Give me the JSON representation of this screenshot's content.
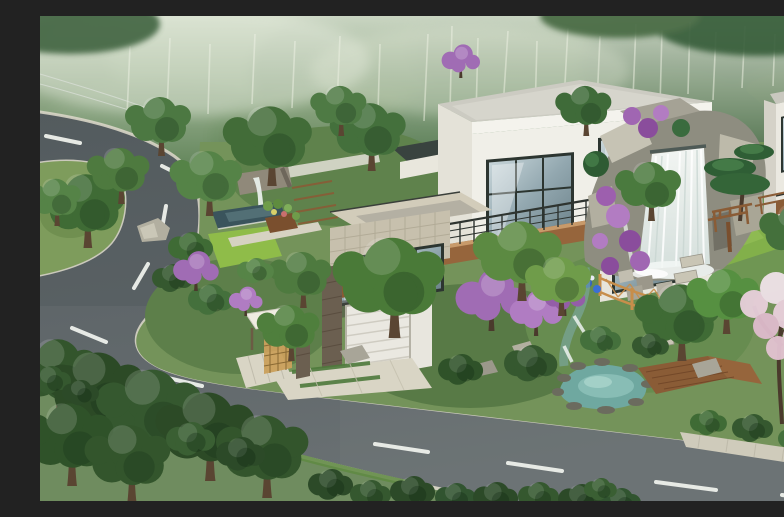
{
  "meta": {
    "title": "Hillside Villa Landscape Rendering",
    "alt": "Aerial 3D architectural rendering of a modern flat-roofed villa on a forested hillside, with a curved asphalt road with white dashed lane markings, a grass traffic island, terraced gardens, a large rock waterfall with purple bougainvillea, a turquoise garden pond with wooden deck, an entrance gate with white canopy, and misty birch forest in the background."
  },
  "scene": {
    "background_forest": {
      "label": "Misty forest backdrop with birch trunks",
      "haze": "#e3ead9",
      "far_green": "#7d9672",
      "mid_green": "#55744e"
    },
    "road": {
      "label": "Curved asphalt road (S-bend with hairpin)",
      "surface": "#5f676a",
      "lane_dash": "#eef1ec",
      "curb": "#d8d5c6",
      "sidewalk": "#cfccbc",
      "dash_count": 12
    },
    "traffic_island": {
      "label": "Grass island with trees",
      "grass": "#7e9c5c",
      "tree_count": 3
    },
    "villa": {
      "label": "Modern flat-roof villa with garage",
      "wall_white": "#f0efe8",
      "roof": "#cccbc2",
      "tile_cladding": "#c7c0ad",
      "wood_accent": "#96653c",
      "window_frame": "#2c3530",
      "glass": "#a9bcc2",
      "garage_door": "#eae8e1",
      "stone_pier": "#6b5f50"
    },
    "neighbor_house": {
      "label": "Neighboring villa at right edge",
      "wall": "#ebe9e1",
      "wood_band": "#8a5c36"
    },
    "entrance_gate": {
      "label": "Entrance gate with white canopy and lattice door",
      "canopy": "#efece1",
      "lattice": "#caa05c"
    },
    "pool_garden": {
      "label": "Reflecting-pool terrace with small waterfall and planters",
      "pool_water": "#3a545c",
      "stone_wall": "#90897a",
      "soil_bed": "#7a4f2e"
    },
    "waterfall": {
      "label": "Large rock waterfall",
      "rock_light": "#c6c3b4",
      "rock_mid": "#8e8d80",
      "water": "#edf2ef",
      "bougainvillea": "#9d5fae"
    },
    "pond": {
      "label": "Turquoise garden pond",
      "water": "#6fa8a0",
      "shallow": "#8fc2ba"
    },
    "deck": {
      "label": "Wooden deck and bridge",
      "wood": "#8a5c36"
    },
    "fence": {
      "label": "Wooden lattice fence around spa stones",
      "wood": "#c78e4b"
    },
    "lawns": {
      "label": "Lawn patches",
      "bright": "#8fbc49",
      "mid": "#82b04a"
    },
    "planting": {
      "label": "Trees and shrubs",
      "tree_dark": "#33552c",
      "tree_mid": "#4a7a38",
      "tree_light": "#6f9c4a",
      "shrub_dark": "#2c4a28",
      "redbud_purple": "#a06cb4",
      "blossom_pink": "#e9d0dc"
    },
    "power_lines": {
      "label": "Overhead power lines, top-left",
      "color": "#e0e4df"
    }
  }
}
